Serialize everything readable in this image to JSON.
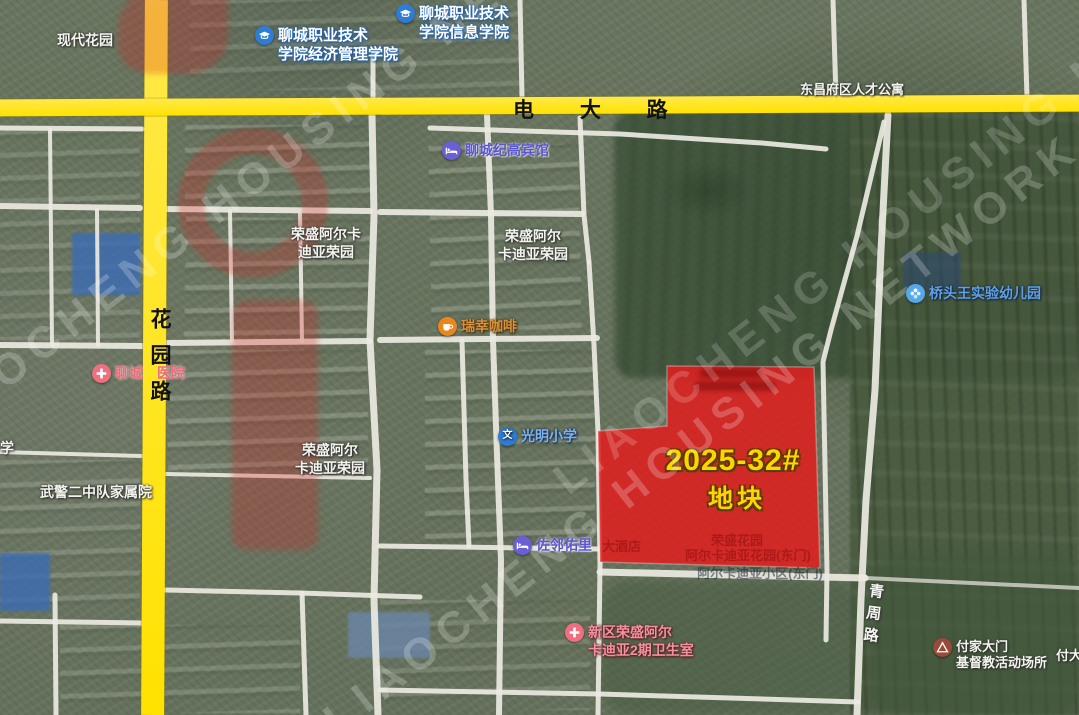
{
  "map": {
    "roads": {
      "dianda": {
        "name": "电 大 路"
      },
      "huayuan": {
        "name": "花园路"
      },
      "qingzhou": {
        "name": "青周路"
      }
    },
    "parcel": {
      "title": "2025-32#",
      "subtitle": "地块",
      "fill": "#e01f1f",
      "fill_opacity": 0.87,
      "text_color": "#ffd400",
      "points": "667,366 814,367 820,568 600,562 598,431 667,426"
    },
    "labels": [
      {
        "id": "xiandai-huayuan",
        "kind": "place",
        "center": true,
        "x": 85,
        "y": 32,
        "lines": [
          "现代花园"
        ]
      },
      {
        "id": "lc-vocational-econ-school",
        "kind": "school",
        "icon": "cap",
        "x": 255,
        "y": 27,
        "lines": [
          "聊城职业技术",
          "学院经济管理学院"
        ]
      },
      {
        "id": "lc-vocational-info-school",
        "kind": "school",
        "icon": "cap",
        "x": 396,
        "y": 5,
        "lines": [
          "聊城职业技术",
          "学院信息学院"
        ]
      },
      {
        "id": "talent-apartment",
        "kind": "place",
        "center": true,
        "size": 13,
        "x": 852,
        "y": 82,
        "lines": [
          "东昌府区人才公寓"
        ]
      },
      {
        "id": "jigao-hotel",
        "kind": "hotel",
        "icon": "bed",
        "x": 442,
        "y": 142,
        "lines": [
          "聊城纪高宾馆"
        ]
      },
      {
        "id": "rongsheng-arcadia-1",
        "kind": "place",
        "center": true,
        "x": 326,
        "y": 226,
        "lines": [
          "荣盛阿尔卡",
          "迪亚荣园"
        ]
      },
      {
        "id": "rongsheng-arcadia-2",
        "kind": "place",
        "center": true,
        "x": 533,
        "y": 228,
        "lines": [
          "荣盛阿尔",
          "卡迪亚荣园"
        ]
      },
      {
        "id": "qiaotouwang-kindergarten",
        "kind": "kids",
        "icon": "pinwheel",
        "x": 906,
        "y": 285,
        "lines": [
          "桥头王实验幼儿园"
        ]
      },
      {
        "id": "luckin-coffee",
        "kind": "coffee",
        "icon": "cup",
        "x": 438,
        "y": 318,
        "lines": [
          "瑞幸咖啡"
        ]
      },
      {
        "id": "liaocheng-hospital",
        "kind": "medical",
        "icon": "cross",
        "x": 92,
        "y": 365,
        "lines": [
          "聊城　医院"
        ]
      },
      {
        "id": "rongsheng-arcadia-3",
        "kind": "place",
        "center": true,
        "x": 330,
        "y": 442,
        "lines": [
          "荣盛阿尔",
          "卡迪亚荣园"
        ]
      },
      {
        "id": "xue-partial",
        "kind": "place",
        "x": 0,
        "y": 440,
        "lines": [
          "学"
        ]
      },
      {
        "id": "guangming-school",
        "kind": "school-wen",
        "icon": "wen",
        "x": 498,
        "y": 428,
        "lines": [
          "光明小学"
        ]
      },
      {
        "id": "wujing-family-compound",
        "kind": "place",
        "center": true,
        "x": 96,
        "y": 484,
        "lines": [
          "武警二中队家属院"
        ]
      },
      {
        "id": "zuolin-youli-hotel",
        "kind": "hotel",
        "icon": "bed",
        "x": 513,
        "y": 537,
        "lines": [
          "佐邻佑里"
        ]
      },
      {
        "id": "zuolin-suffix-obscured",
        "kind": "faint-on-red",
        "x": 602,
        "y": 539,
        "lines": [
          "大酒店"
        ]
      },
      {
        "id": "parcel-obscured-1",
        "kind": "faint-on-red",
        "center": true,
        "x": 737,
        "y": 533,
        "lines": [
          "荣盛花园"
        ]
      },
      {
        "id": "parcel-obscured-2",
        "kind": "faint-on-red",
        "center": true,
        "x": 748,
        "y": 548,
        "lines": [
          "阿尔卡迪亚花园(东门)"
        ]
      },
      {
        "id": "below-parcel-obscured",
        "kind": "dark-faint",
        "center": true,
        "x": 760,
        "y": 566,
        "lines": [
          "阿尔卡迪亚小区(东门)"
        ]
      },
      {
        "id": "community-clinic",
        "kind": "clinic",
        "icon": "cross",
        "x": 565,
        "y": 624,
        "lines": [
          "新区荣盛阿尔",
          "卡迪亚2期卫生室"
        ]
      },
      {
        "id": "fujiadamen-church",
        "kind": "church",
        "icon": "tent",
        "x": 933,
        "y": 639,
        "lines": [
          "付家大门",
          "基督教活动场所"
        ]
      },
      {
        "id": "fuda-partial",
        "kind": "place",
        "size": 13,
        "x": 1056,
        "y": 648,
        "lines": [
          "付大"
        ]
      }
    ]
  },
  "watermark": {
    "diagonal_text": "LIAOCHENG HOUSING NETWORK"
  }
}
